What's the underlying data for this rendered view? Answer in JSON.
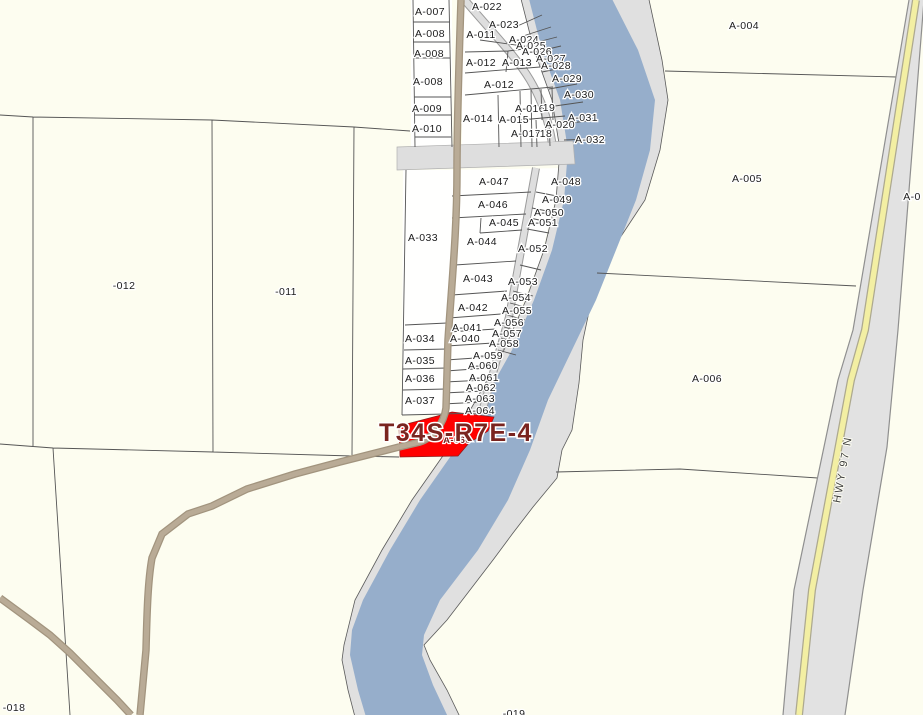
{
  "map": {
    "selected_parcel": {
      "title": "T34S-R7E-4",
      "label": "A-066"
    },
    "highway_label": "HWY 97 N",
    "colors": {
      "background": "#fdfdf0",
      "parcel_fill": "#fffffe",
      "selected_fill": "#ff0000",
      "selected_text": "#7a241f",
      "river": "#96aecb",
      "river_bank": "#e0e0e0",
      "minor_road": "#dedede",
      "dirt_road": "#b9ab96",
      "highway_surface": "#e2e2e2",
      "highway_stripe": "#f3efa3",
      "boundary_line": "#555555"
    },
    "labels": [
      {
        "t": "A-007",
        "x": 430,
        "y": 11
      },
      {
        "t": "A-008",
        "x": 430,
        "y": 33
      },
      {
        "t": "A-008",
        "x": 429,
        "y": 53
      },
      {
        "t": "A-008",
        "x": 428,
        "y": 81
      },
      {
        "t": "A-009",
        "x": 427,
        "y": 108
      },
      {
        "t": "A-010",
        "x": 427,
        "y": 128
      },
      {
        "t": "A-022",
        "x": 487,
        "y": 6
      },
      {
        "t": "A-023",
        "x": 504,
        "y": 24
      },
      {
        "t": "A-011",
        "x": 481,
        "y": 34
      },
      {
        "t": "A-024",
        "x": 524,
        "y": 39
      },
      {
        "t": "A-025",
        "x": 531,
        "y": 45
      },
      {
        "t": "A-026",
        "x": 537,
        "y": 51
      },
      {
        "t": "A-012",
        "x": 481,
        "y": 62
      },
      {
        "t": "A-013",
        "x": 517,
        "y": 62
      },
      {
        "t": "A-027",
        "x": 551,
        "y": 58
      },
      {
        "t": "A-028",
        "x": 556,
        "y": 65
      },
      {
        "t": "A-029",
        "x": 567,
        "y": 78
      },
      {
        "t": "A-012",
        "x": 499,
        "y": 84
      },
      {
        "t": "A-030",
        "x": 579,
        "y": 94
      },
      {
        "t": "A-016",
        "x": 530,
        "y": 108
      },
      {
        "t": "19",
        "x": 549,
        "y": 107
      },
      {
        "t": "A-014",
        "x": 478,
        "y": 118
      },
      {
        "t": "A-015",
        "x": 514,
        "y": 119
      },
      {
        "t": "A-031",
        "x": 583,
        "y": 117
      },
      {
        "t": "A-020",
        "x": 560,
        "y": 124
      },
      {
        "t": "A-017",
        "x": 526,
        "y": 133
      },
      {
        "t": "18",
        "x": 546,
        "y": 133
      },
      {
        "t": "A-032",
        "x": 590,
        "y": 139
      },
      {
        "t": "A-033",
        "x": 423,
        "y": 237
      },
      {
        "t": "A-047",
        "x": 494,
        "y": 181
      },
      {
        "t": "A-048",
        "x": 566,
        "y": 181
      },
      {
        "t": "A-046",
        "x": 493,
        "y": 204
      },
      {
        "t": "A-049",
        "x": 557,
        "y": 199
      },
      {
        "t": "A-050",
        "x": 549,
        "y": 212
      },
      {
        "t": "A-045",
        "x": 504,
        "y": 222
      },
      {
        "t": "A-051",
        "x": 543,
        "y": 222
      },
      {
        "t": "A-044",
        "x": 482,
        "y": 241
      },
      {
        "t": "A-052",
        "x": 533,
        "y": 248
      },
      {
        "t": "A-043",
        "x": 478,
        "y": 278
      },
      {
        "t": "A-053",
        "x": 523,
        "y": 281
      },
      {
        "t": "A-054",
        "x": 516,
        "y": 297
      },
      {
        "t": "A-042",
        "x": 473,
        "y": 307
      },
      {
        "t": "A-055",
        "x": 517,
        "y": 310
      },
      {
        "t": "A-041",
        "x": 467,
        "y": 327
      },
      {
        "t": "A-056",
        "x": 509,
        "y": 322
      },
      {
        "t": "A-040",
        "x": 465,
        "y": 338
      },
      {
        "t": "A-057",
        "x": 507,
        "y": 333
      },
      {
        "t": "A-058",
        "x": 504,
        "y": 343
      },
      {
        "t": "A-034",
        "x": 420,
        "y": 338
      },
      {
        "t": "A-059",
        "x": 488,
        "y": 355
      },
      {
        "t": "A-060",
        "x": 483,
        "y": 365
      },
      {
        "t": "A-035",
        "x": 420,
        "y": 360
      },
      {
        "t": "A-061",
        "x": 484,
        "y": 377
      },
      {
        "t": "A-036",
        "x": 420,
        "y": 378
      },
      {
        "t": "A-062",
        "x": 481,
        "y": 387
      },
      {
        "t": "A-037",
        "x": 420,
        "y": 400
      },
      {
        "t": "A-063",
        "x": 480,
        "y": 398
      },
      {
        "t": "A-064",
        "x": 480,
        "y": 410
      },
      {
        "t": "A-004",
        "x": 744,
        "y": 25
      },
      {
        "t": "A-005",
        "x": 747,
        "y": 178
      },
      {
        "t": "A-006",
        "x": 707,
        "y": 378
      },
      {
        "t": "A-0",
        "x": 912,
        "y": 196
      },
      {
        "t": "-012",
        "x": 124,
        "y": 285
      },
      {
        "t": "-011",
        "x": 286,
        "y": 291
      },
      {
        "t": "-018",
        "x": 14,
        "y": 707
      },
      {
        "t": "-019",
        "x": 514,
        "y": 713
      }
    ]
  }
}
